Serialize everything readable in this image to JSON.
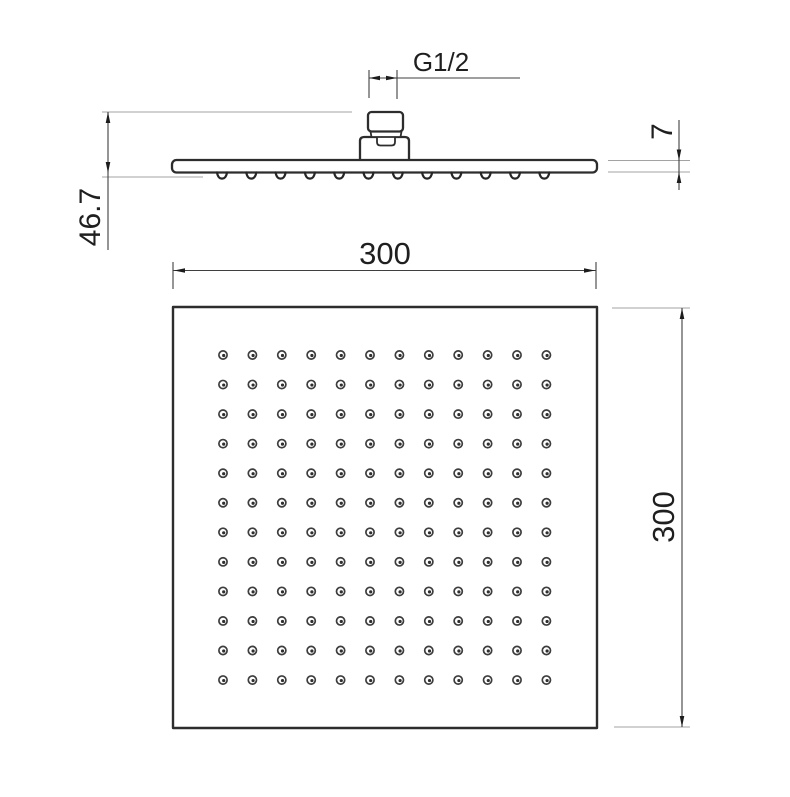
{
  "drawing": {
    "product": "square-shower-head-dimensional-drawing",
    "labels": {
      "thread": "G1/2",
      "total_height": "46.7",
      "plate_thickness": "7",
      "face_width": "300",
      "face_height": "300"
    },
    "nozzle_grid": {
      "rows": 12,
      "cols": 12
    },
    "side_nozzle_count": 12,
    "colors": {
      "outline": "#2d2d2d",
      "dimension_line": "#3f3f3f",
      "extension_line": "#a3a3a3",
      "text": "#1f1f1f",
      "background": "#ffffff"
    }
  }
}
